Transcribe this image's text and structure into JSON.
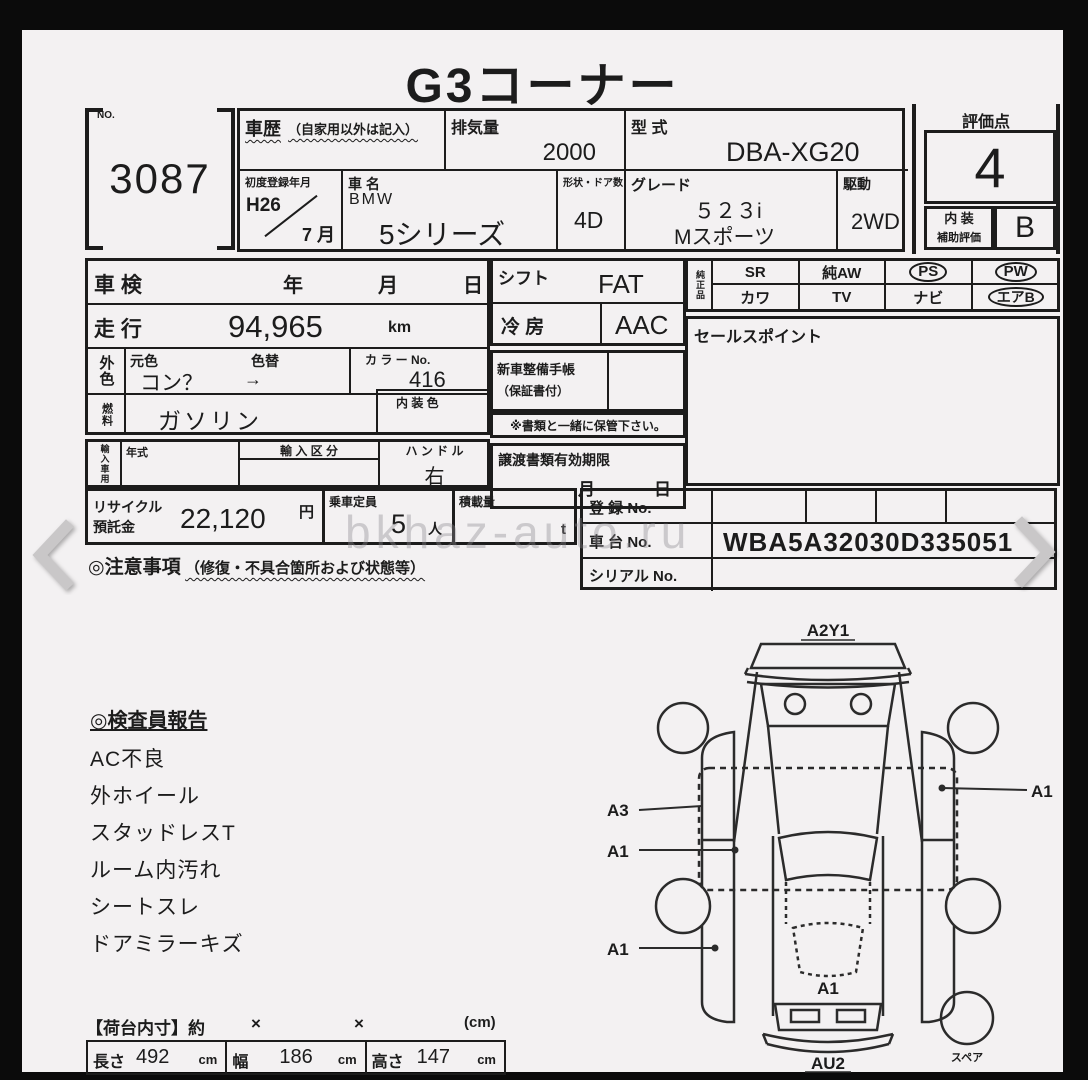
{
  "title": "G3コーナー",
  "watermark": "bkhaz-auto.ru",
  "carousel": {
    "prev": "‹",
    "next": "›"
  },
  "header": {
    "no_label": "NO.",
    "no_value": "3087",
    "history_label": "車歴",
    "history_note": "（自家用以外は記入）",
    "displacement_label": "排気量",
    "displacement_value": "2000",
    "model_code_label": "型  式",
    "model_code_value": "DBA-XG20",
    "first_reg_label": "初度登録年月",
    "first_reg_year": "H26",
    "first_reg_month": "7 月",
    "car_name_label": "車  名",
    "car_make": "BMW",
    "car_model": "5シリーズ",
    "doors_label": "形状・ドア数",
    "doors_value": "4D",
    "grade_label": "グレード",
    "grade_line1": "５２３i",
    "grade_line2": "Mスポーツ",
    "drive_label": "駆動",
    "drive_value": "2WD",
    "score_label": "評価点",
    "score_value": "4",
    "interior_score_label1": "内 装",
    "interior_score_label2": "補助評価",
    "interior_score_value": "B"
  },
  "main": {
    "shaken_label": "車 検",
    "shaken_year": "年",
    "shaken_month": "月",
    "shaken_day": "日",
    "mileage_label": "走 行",
    "mileage_value": "94,965",
    "mileage_unit": "km",
    "ext_color_label": "外色",
    "orig_color_label": "元色",
    "color_change_label": "色替",
    "orig_color_value": "コン？",
    "color_arrow": "→",
    "color_no_label": "カ ラ ー No.",
    "color_no_value": "416",
    "fuel_label": "燃料",
    "fuel_value": "ガソリン",
    "interior_color_label": "内 装 色",
    "import_label": "輸入車用",
    "year_type_label": "年式",
    "import_class_label": "輸 入 区 分",
    "handle_label": "ハ ン ド ル",
    "handle_value": "右",
    "shift_label": "シフト",
    "shift_value": "FAT",
    "ac_label": "冷  房",
    "ac_value": "AAC",
    "service_book_label": "新車整備手帳",
    "service_book_note": "（保証書付）",
    "keep_note": "※書類と一緒に保管下さい。",
    "transfer_label": "譲渡書類有効期限",
    "transfer_month": "月",
    "transfer_day": "日",
    "oem_label": "純正品",
    "equipment": {
      "rows": [
        [
          {
            "label": "SR",
            "circled": false
          },
          {
            "label": "純AW",
            "circled": false
          },
          {
            "label": "PS",
            "circled": true
          },
          {
            "label": "PW",
            "circled": true
          }
        ],
        [
          {
            "label": "カワ",
            "circled": false
          },
          {
            "label": "TV",
            "circled": false
          },
          {
            "label": "ナビ",
            "circled": false
          },
          {
            "label": "エアB",
            "circled": true
          }
        ]
      ]
    },
    "sales_point_label": "セールスポイント"
  },
  "bottom": {
    "recycle_label1": "リサイクル",
    "recycle_label2": "預託金",
    "recycle_value": "22,120",
    "recycle_unit": "円",
    "capacity_label": "乗車定員",
    "capacity_value": "5",
    "capacity_unit": "人",
    "load_label": "積載量",
    "load_unit": "t",
    "caution_label": "◎注意事項",
    "caution_note": "（修復・不具合箇所および状態等）",
    "reg_no_label": "登  録 No.",
    "chassis_label": "車  台 No.",
    "chassis_value": "WBA5A32030D335051",
    "serial_label": "シリアル No."
  },
  "inspector_report": {
    "title": "◎検査員報告",
    "items": [
      "AC不良",
      "外ホイール",
      "スタッドレスT",
      "ルーム内汚れ",
      "シートスレ",
      "ドアミラーキズ"
    ]
  },
  "dimensions": {
    "header_label": "【荷台内寸】約",
    "times1": "×",
    "times2": "×",
    "unit_note": "(cm)",
    "length_label": "長さ",
    "length_value": "492",
    "length_unit": "cm",
    "width_label": "幅",
    "width_value": "186",
    "width_unit": "cm",
    "height_label": "高さ",
    "height_value": "147",
    "height_unit": "cm"
  },
  "diagram": {
    "labels": {
      "front": "A2Y1",
      "left_side": "A3",
      "left_door": "A1",
      "left_rear": "A1",
      "right_door": "A1",
      "trunk": "A1",
      "rear": "AU2",
      "spare": "スペア"
    }
  },
  "colors": {
    "frame": "#0b0b0b",
    "paper": "#f3f1f2",
    "ink": "#1c1c1c",
    "arrow_gray": "#c9c7c8"
  }
}
